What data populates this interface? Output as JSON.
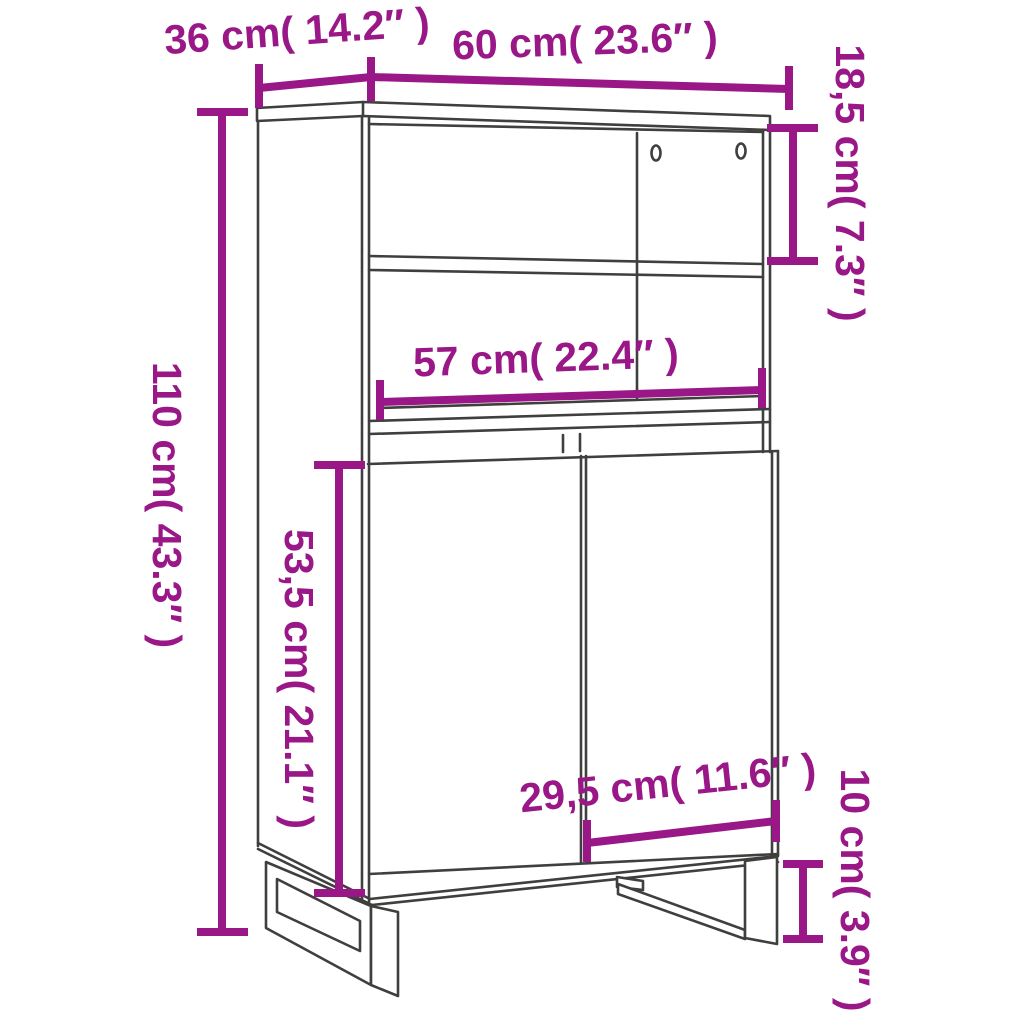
{
  "figure": {
    "kind": "furniture dimension diagram",
    "product": "highboard cabinet with two open shelves, two doors and U-shaped metal legs"
  },
  "colors": {
    "dimension-color": "#991787",
    "line-color": "#3f3f3e",
    "background-color": "#ffffff"
  },
  "dimensions": {
    "depth": {
      "value_cm": "36",
      "value_in": "14.2",
      "label": "36 cm( 14.2″ )"
    },
    "width": {
      "value_cm": "60",
      "value_in": "23.6",
      "label": "60 cm( 23.6″ )"
    },
    "top_shelf": {
      "value_cm": "18,5",
      "value_in": "7.3",
      "label": "18,5 cm( 7.3″ )"
    },
    "total_height": {
      "value_cm": "110",
      "value_in": "43.3",
      "label": "110 cm( 43.3″ )"
    },
    "inner_width": {
      "value_cm": "57",
      "value_in": "22.4",
      "label": "57 cm( 22.4″ )"
    },
    "door_height": {
      "value_cm": "53,5",
      "value_in": "21.1",
      "label": "53,5 cm( 21.1″ )"
    },
    "door_width": {
      "value_cm": "29,5",
      "value_in": "11.6",
      "label": "29,5 cm( 11.6″ )"
    },
    "leg_height": {
      "value_cm": "10",
      "value_in": "3.9",
      "label": "10 cm( 3.9″ )"
    }
  }
}
